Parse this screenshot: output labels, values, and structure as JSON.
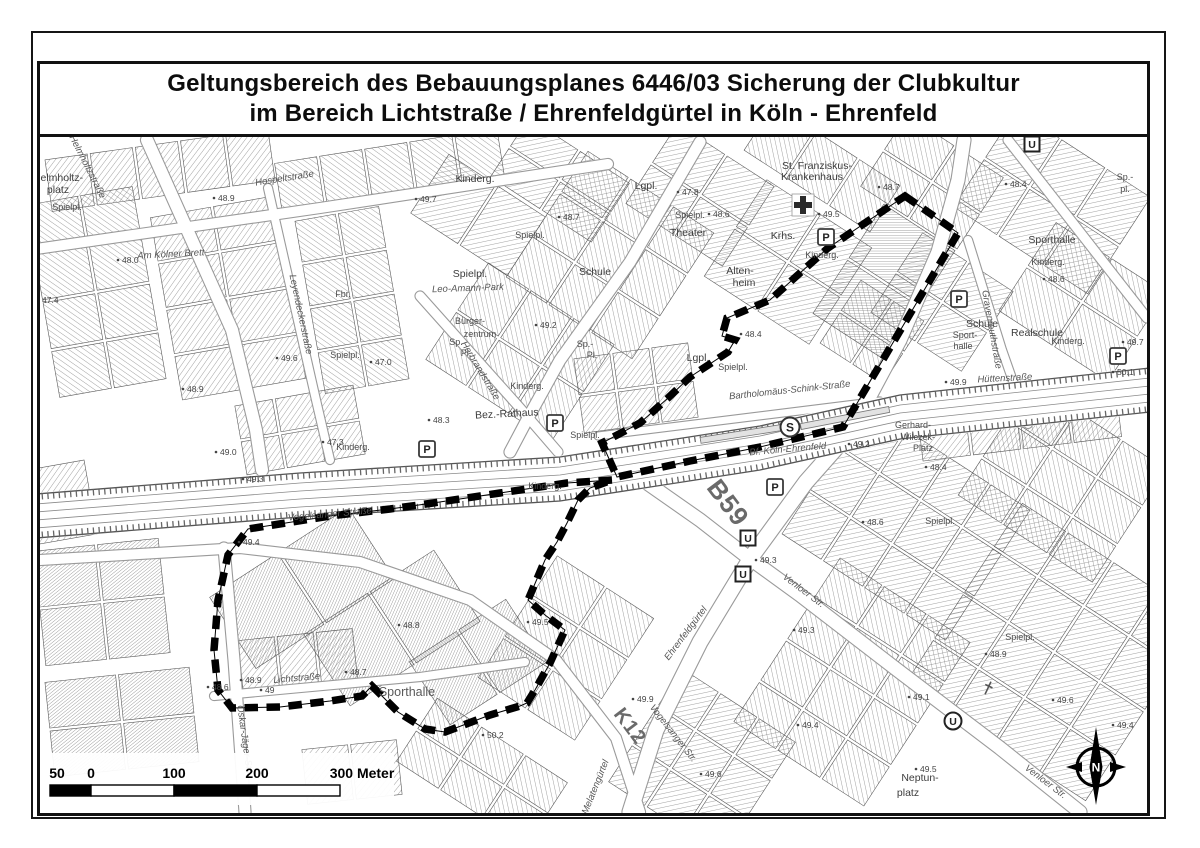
{
  "title": {
    "line1": "Geltungsbereich des Bebauungsplanes 6446/03 Sicherung der Clubkultur",
    "line2": "im Bereich Lichtstraße / Ehrenfeldgürtel in Köln - Ehrenfeld"
  },
  "map": {
    "boundary_color": "#000000",
    "boundary_loops": [
      [
        [
          905,
          196
        ],
        [
          958,
          233
        ],
        [
          843,
          427
        ],
        [
          760,
          447
        ],
        [
          690,
          461
        ],
        [
          617,
          477
        ],
        [
          602,
          443
        ],
        [
          640,
          423
        ],
        [
          668,
          398
        ],
        [
          690,
          377
        ],
        [
          728,
          352
        ],
        [
          735,
          340
        ],
        [
          722,
          336
        ],
        [
          727,
          318
        ],
        [
          770,
          300
        ],
        [
          800,
          273
        ],
        [
          828,
          248
        ]
      ],
      [
        [
          612,
          480
        ],
        [
          567,
          483
        ],
        [
          500,
          493
        ],
        [
          433,
          503
        ],
        [
          390,
          509
        ],
        [
          330,
          516
        ],
        [
          248,
          529
        ],
        [
          228,
          555
        ],
        [
          218,
          600
        ],
        [
          214,
          650
        ],
        [
          218,
          690
        ],
        [
          232,
          708
        ],
        [
          280,
          707
        ],
        [
          330,
          701
        ],
        [
          362,
          696
        ],
        [
          372,
          686
        ],
        [
          398,
          712
        ],
        [
          425,
          729
        ],
        [
          445,
          732
        ],
        [
          490,
          715
        ],
        [
          520,
          706
        ],
        [
          527,
          703
        ],
        [
          535,
          690
        ],
        [
          550,
          663
        ],
        [
          565,
          630
        ],
        [
          545,
          615
        ],
        [
          528,
          600
        ],
        [
          545,
          560
        ],
        [
          557,
          542
        ],
        [
          567,
          523
        ],
        [
          578,
          500
        ],
        [
          590,
          488
        ]
      ]
    ],
    "labels": [
      {
        "t": "Helmholtz-",
        "x": 58,
        "y": 181,
        "r": 0,
        "c": "lbl-place"
      },
      {
        "t": "platz",
        "x": 58,
        "y": 193,
        "r": 0,
        "c": "lbl-place"
      },
      {
        "t": "Spielpl.",
        "x": 67,
        "y": 210,
        "r": 0,
        "c": "lbl-small"
      },
      {
        "t": "Helmholtzstraße",
        "x": 85,
        "y": 168,
        "r": 63,
        "c": "lbl-street"
      },
      {
        "t": "Hospeltstraße",
        "x": 285,
        "y": 181,
        "r": -9,
        "c": "lbl-street"
      },
      {
        "t": "Am Kölner Brett",
        "x": 171,
        "y": 257,
        "r": -3,
        "c": "lbl-street"
      },
      {
        "t": "Leyendeckerstraße",
        "x": 298,
        "y": 315,
        "r": 78,
        "c": "lbl-street"
      },
      {
        "t": "Kinderg.",
        "x": 475,
        "y": 182,
        "r": 0,
        "c": "lbl-place"
      },
      {
        "t": "Fbr.",
        "x": 343,
        "y": 297,
        "r": 0,
        "c": "lbl-small"
      },
      {
        "t": "Spielpl.",
        "x": 345,
        "y": 358,
        "r": 0,
        "c": "lbl-small"
      },
      {
        "t": "Spielpl.",
        "x": 530,
        "y": 238,
        "r": 0,
        "c": "lbl-small"
      },
      {
        "t": "Spielpl.",
        "x": 470,
        "y": 277,
        "r": 0,
        "c": "lbl-place"
      },
      {
        "t": "Leo-Amann-Park",
        "x": 468,
        "y": 291,
        "r": -2,
        "c": "lbl-street"
      },
      {
        "t": "Bürger-",
        "x": 470,
        "y": 324,
        "r": 0,
        "c": "lbl-small"
      },
      {
        "t": "zentrum",
        "x": 480,
        "y": 337,
        "r": 0,
        "c": "lbl-small"
      },
      {
        "t": "Sp.",
        "x": 456,
        "y": 345,
        "r": 0,
        "c": "lbl-small"
      },
      {
        "t": "Pl.",
        "x": 466,
        "y": 356,
        "r": 0,
        "c": "lbl-small"
      },
      {
        "t": "Sp.-",
        "x": 585,
        "y": 347,
        "r": 0,
        "c": "lbl-small"
      },
      {
        "t": "Pl.",
        "x": 592,
        "y": 358,
        "r": 0,
        "c": "lbl-small"
      },
      {
        "t": "Schule",
        "x": 595,
        "y": 275,
        "r": 0,
        "c": "lbl-place"
      },
      {
        "t": "Theater",
        "x": 688,
        "y": 236,
        "r": 0,
        "c": "lbl-place"
      },
      {
        "t": "Lgpl.",
        "x": 646,
        "y": 189,
        "r": 0,
        "c": "lbl-place"
      },
      {
        "t": "Lgpl.",
        "x": 698,
        "y": 361,
        "r": 0,
        "c": "lbl-place"
      },
      {
        "t": "Spielpl.",
        "x": 690,
        "y": 218,
        "r": 0,
        "c": "lbl-small"
      },
      {
        "t": "Spielpl.",
        "x": 733,
        "y": 370,
        "r": 0,
        "c": "lbl-small"
      },
      {
        "t": "Spielpl.",
        "x": 585,
        "y": 438,
        "r": 0,
        "c": "lbl-small"
      },
      {
        "t": "St. Franziskus-",
        "x": 817,
        "y": 169,
        "r": 0,
        "c": "lbl-place"
      },
      {
        "t": "Krankenhaus",
        "x": 812,
        "y": 180,
        "r": 0,
        "c": "lbl-place"
      },
      {
        "t": "Krhs.",
        "x": 783,
        "y": 239,
        "r": 0,
        "c": "lbl-place"
      },
      {
        "t": "Alten-",
        "x": 740,
        "y": 274,
        "r": 0,
        "c": "lbl-place"
      },
      {
        "t": "heim",
        "x": 744,
        "y": 286,
        "r": 0,
        "c": "lbl-place"
      },
      {
        "t": "Kinderg.",
        "x": 822,
        "y": 258,
        "r": 0,
        "c": "lbl-small"
      },
      {
        "t": "Sporthalle",
        "x": 1052,
        "y": 243,
        "r": 0,
        "c": "lbl-place"
      },
      {
        "t": "Kinderg.",
        "x": 1048,
        "y": 265,
        "r": 0,
        "c": "lbl-small"
      },
      {
        "t": "Sp.-",
        "x": 1125,
        "y": 180,
        "r": 0,
        "c": "lbl-small"
      },
      {
        "t": "pl.",
        "x": 1125,
        "y": 192,
        "r": 0,
        "c": "lbl-small"
      },
      {
        "t": "Schule",
        "x": 982,
        "y": 327,
        "r": 0,
        "c": "lbl-place"
      },
      {
        "t": "Sport-",
        "x": 965,
        "y": 338,
        "r": 0,
        "c": "lbl-small"
      },
      {
        "t": "halle",
        "x": 963,
        "y": 349,
        "r": 0,
        "c": "lbl-small"
      },
      {
        "t": "Realschule",
        "x": 1037,
        "y": 336,
        "r": 0,
        "c": "lbl-place"
      },
      {
        "t": "Kinderg.",
        "x": 1068,
        "y": 344,
        "r": 0,
        "c": "lbl-small"
      },
      {
        "t": "Gravenreuthstraße",
        "x": 989,
        "y": 330,
        "r": 80,
        "c": "lbl-street"
      },
      {
        "t": "Hüttenstraße",
        "x": 1005,
        "y": 381,
        "r": -3,
        "c": "lbl-street"
      },
      {
        "t": "Bartholomäus-Schink-Straße",
        "x": 790,
        "y": 393,
        "r": -6,
        "c": "lbl-street"
      },
      {
        "t": "Bf. Köln-Ehrenfeld",
        "x": 788,
        "y": 452,
        "r": -5,
        "c": "lbl-street"
      },
      {
        "t": "Gerhard-",
        "x": 913,
        "y": 428,
        "r": 0,
        "c": "lbl-small"
      },
      {
        "t": "Wilczek-",
        "x": 918,
        "y": 440,
        "r": 0,
        "c": "lbl-small"
      },
      {
        "t": "Platz",
        "x": 923,
        "y": 451,
        "r": 0,
        "c": "lbl-small"
      },
      {
        "t": "Herbrandstraße",
        "x": 478,
        "y": 372,
        "r": 59,
        "c": "lbl-street"
      },
      {
        "t": "Bez.-Rathaus",
        "x": 507,
        "y": 417,
        "r": -3,
        "c": "lbl-place"
      },
      {
        "t": "Kinderg.",
        "x": 527,
        "y": 389,
        "r": 0,
        "c": "lbl-small"
      },
      {
        "t": "Kinderg.",
        "x": 545,
        "y": 489,
        "r": 0,
        "c": "lbl-small"
      },
      {
        "t": "Kinderg.",
        "x": 353,
        "y": 450,
        "r": 0,
        "c": "lbl-small"
      },
      {
        "t": "Spielpl.",
        "x": 940,
        "y": 524,
        "r": 0,
        "c": "lbl-small"
      },
      {
        "t": "Spielpl.",
        "x": 1020,
        "y": 640,
        "r": 0,
        "c": "lbl-small"
      },
      {
        "t": "B59",
        "x": 721,
        "y": 508,
        "r": 53,
        "c": "lbl-big"
      },
      {
        "t": "K12",
        "x": 625,
        "y": 730,
        "r": 53,
        "c": "lbl-big2"
      },
      {
        "t": "Ehrenfeldgürtel",
        "x": 688,
        "y": 635,
        "r": -53,
        "c": "lbl-street"
      },
      {
        "t": "Melatengürtel",
        "x": 598,
        "y": 788,
        "r": -68,
        "c": "lbl-street"
      },
      {
        "t": "Venloer Str.",
        "x": 802,
        "y": 593,
        "r": 37,
        "c": "lbl-street"
      },
      {
        "t": "Venloer Str.",
        "x": 1044,
        "y": 784,
        "r": 37,
        "c": "lbl-street"
      },
      {
        "t": "Vogelsanger Straße",
        "x": 330,
        "y": 517,
        "r": -5,
        "c": "lbl-street"
      },
      {
        "t": "Vogelsanger Str.",
        "x": 671,
        "y": 735,
        "r": 52,
        "c": "lbl-street"
      },
      {
        "t": "Lichtstraße",
        "x": 297,
        "y": 681,
        "r": -5,
        "c": "lbl-street"
      },
      {
        "t": "Oskar-Jäger-Str.",
        "x": 242,
        "y": 740,
        "r": 82,
        "c": "lbl-street"
      },
      {
        "t": "Sporthalle",
        "x": 407,
        "y": 696,
        "r": 0,
        "c": "lbl-med"
      },
      {
        "t": "Neptun-",
        "x": 920,
        "y": 781,
        "r": 0,
        "c": "lbl-place"
      },
      {
        "t": "platz",
        "x": 908,
        "y": 796,
        "r": 0,
        "c": "lbl-place"
      }
    ],
    "elevations": [
      {
        "t": "47.4",
        "x": 42,
        "y": 298
      },
      {
        "t": "48.0",
        "x": 122,
        "y": 258
      },
      {
        "t": "48.9",
        "x": 218,
        "y": 196
      },
      {
        "t": "49.6",
        "x": 281,
        "y": 356
      },
      {
        "t": "47.0",
        "x": 375,
        "y": 360
      },
      {
        "t": "49.7",
        "x": 420,
        "y": 197
      },
      {
        "t": "48.7",
        "x": 563,
        "y": 215
      },
      {
        "t": "47.8",
        "x": 682,
        "y": 190
      },
      {
        "t": "48.6",
        "x": 713,
        "y": 212
      },
      {
        "t": "48.7",
        "x": 883,
        "y": 185
      },
      {
        "t": "49.5",
        "x": 823,
        "y": 212
      },
      {
        "t": "48.4",
        "x": 745,
        "y": 332
      },
      {
        "t": "48.4",
        "x": 1010,
        "y": 182
      },
      {
        "t": "48.6",
        "x": 1048,
        "y": 277
      },
      {
        "t": "49.7",
        "x": 1127,
        "y": 340
      },
      {
        "t": "50.1",
        "x": 1117,
        "y": 370
      },
      {
        "t": "49.9",
        "x": 950,
        "y": 380
      },
      {
        "t": "49.2",
        "x": 853,
        "y": 442
      },
      {
        "t": "48.4",
        "x": 930,
        "y": 465
      },
      {
        "t": "48.6",
        "x": 867,
        "y": 520
      },
      {
        "t": "49.3",
        "x": 760,
        "y": 558
      },
      {
        "t": "48.9",
        "x": 187,
        "y": 387
      },
      {
        "t": "49.0",
        "x": 220,
        "y": 450
      },
      {
        "t": "49.3",
        "x": 247,
        "y": 477
      },
      {
        "t": "47.3",
        "x": 327,
        "y": 440
      },
      {
        "t": "49.4",
        "x": 243,
        "y": 540
      },
      {
        "t": "48.3",
        "x": 433,
        "y": 418
      },
      {
        "t": "49.2",
        "x": 540,
        "y": 323
      },
      {
        "t": "48.8",
        "x": 403,
        "y": 623
      },
      {
        "t": "48.7",
        "x": 350,
        "y": 670
      },
      {
        "t": "48.9",
        "x": 245,
        "y": 678
      },
      {
        "t": "48.6",
        "x": 212,
        "y": 685
      },
      {
        "t": "49",
        "x": 265,
        "y": 688
      },
      {
        "t": "50.2",
        "x": 487,
        "y": 733
      },
      {
        "t": "49.5",
        "x": 532,
        "y": 620
      },
      {
        "t": "49.9",
        "x": 637,
        "y": 697
      },
      {
        "t": "49.3",
        "x": 798,
        "y": 628
      },
      {
        "t": "49.4",
        "x": 802,
        "y": 723
      },
      {
        "t": "49.6",
        "x": 705,
        "y": 772
      },
      {
        "t": "49.1",
        "x": 913,
        "y": 695
      },
      {
        "t": "48.9",
        "x": 990,
        "y": 652
      },
      {
        "t": "49.6",
        "x": 1057,
        "y": 698
      },
      {
        "t": "49.5",
        "x": 920,
        "y": 767
      },
      {
        "t": "49.4",
        "x": 1117,
        "y": 723
      }
    ],
    "icons": [
      {
        "type": "parking",
        "t": "P",
        "x": 826,
        "y": 237
      },
      {
        "type": "parking",
        "t": "P",
        "x": 959,
        "y": 299
      },
      {
        "type": "parking",
        "t": "P",
        "x": 1118,
        "y": 356
      },
      {
        "type": "parking",
        "t": "P",
        "x": 427,
        "y": 449
      },
      {
        "type": "parking",
        "t": "P",
        "x": 555,
        "y": 423
      },
      {
        "type": "parking",
        "t": "P",
        "x": 775,
        "y": 487
      },
      {
        "type": "sbahn",
        "t": "S",
        "x": 790,
        "y": 427
      },
      {
        "type": "ubahn",
        "t": "U",
        "x": 1032,
        "y": 144
      },
      {
        "type": "ubahn",
        "t": "U",
        "x": 748,
        "y": 538
      },
      {
        "type": "ubahn",
        "t": "U",
        "x": 743,
        "y": 574
      },
      {
        "type": "ubahn-circle",
        "t": "U",
        "x": 953,
        "y": 721
      },
      {
        "type": "hospital-cross",
        "t": "",
        "x": 803,
        "y": 205
      },
      {
        "type": "church-cross",
        "t": "",
        "x": 988,
        "y": 688
      }
    ],
    "scale_bar": {
      "labels": [
        {
          "t": "50",
          "x": 57
        },
        {
          "t": "0",
          "x": 91
        },
        {
          "t": "100",
          "x": 174
        },
        {
          "t": "200",
          "x": 257
        },
        {
          "t": "300 Meter",
          "x": 362
        }
      ]
    },
    "north_arrow": {
      "label": "N"
    }
  }
}
